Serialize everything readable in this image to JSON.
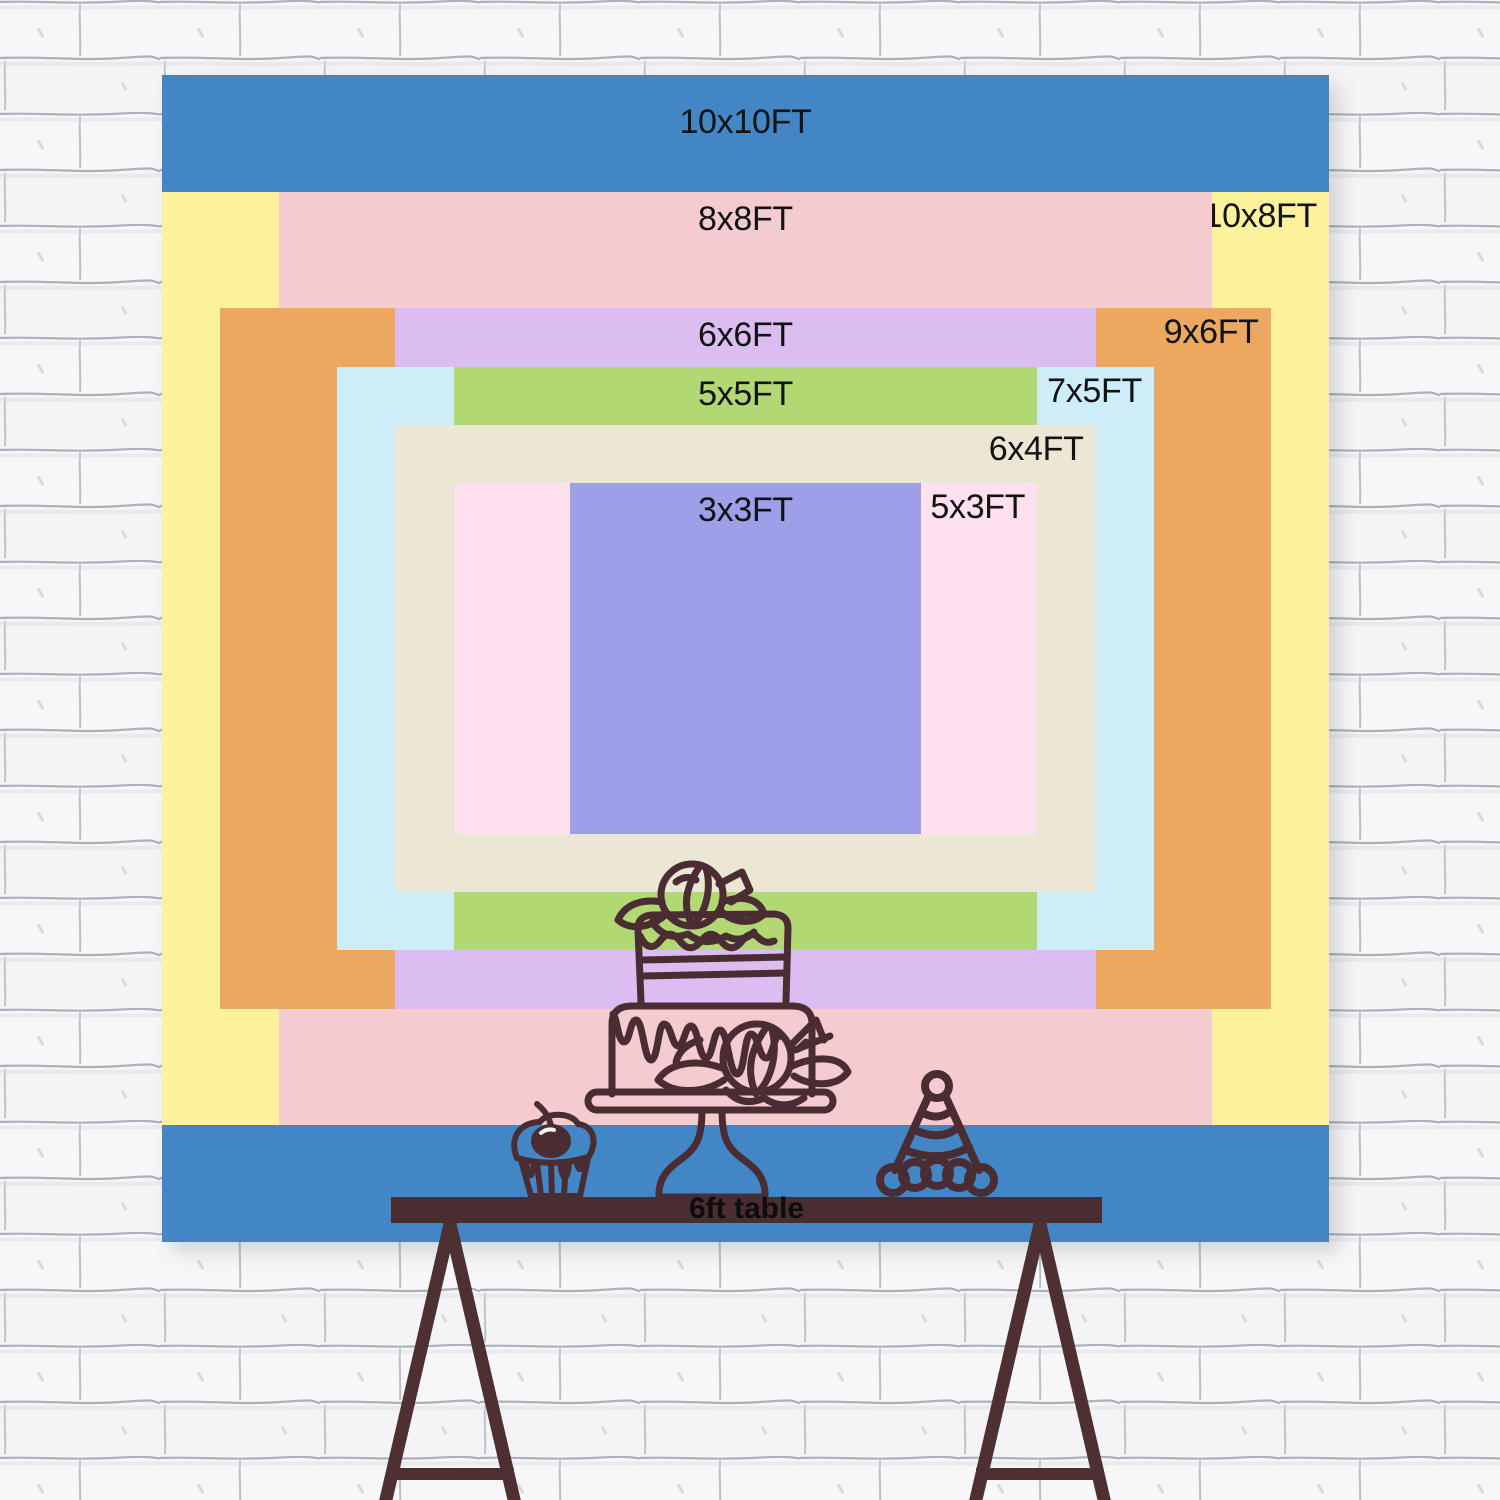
{
  "backdrop_size_chart": {
    "unit": "FT",
    "sizes": [
      {
        "label": "10x10FT",
        "w": 10,
        "h": 10,
        "color": "#4286c6",
        "label_anchor": "top-center"
      },
      {
        "label": "10x8FT",
        "w": 10,
        "h": 8,
        "color": "#fbf29b",
        "label_anchor": "top-right"
      },
      {
        "label": "8x8FT",
        "w": 8,
        "h": 8,
        "color": "#f4cbce",
        "label_anchor": "top-center"
      },
      {
        "label": "9x6FT",
        "w": 9,
        "h": 6,
        "color": "#eba85e",
        "label_anchor": "top-right"
      },
      {
        "label": "6x6FT",
        "w": 6,
        "h": 6,
        "color": "#dcbdf1",
        "label_anchor": "top-center"
      },
      {
        "label": "7x5FT",
        "w": 7,
        "h": 5,
        "color": "#cdeef8",
        "label_anchor": "top-right"
      },
      {
        "label": "5x5FT",
        "w": 5,
        "h": 5,
        "color": "#b2d873",
        "label_anchor": "top-center"
      },
      {
        "label": "6x4FT",
        "w": 6,
        "h": 4,
        "color": "#ece6d4",
        "label_anchor": "top-right"
      },
      {
        "label": "5x3FT",
        "w": 5,
        "h": 3,
        "color": "#fee0ef",
        "label_anchor": "top-right"
      },
      {
        "label": "3x3FT",
        "w": 3,
        "h": 3,
        "color": "#9d9fe8",
        "label_anchor": "top-center"
      }
    ],
    "table": {
      "label": "6ft table",
      "color": "#4a2d31"
    },
    "decoration_icons": [
      "tiered-cake-icon",
      "cupcake-with-cherry-icon",
      "party-hat-icon"
    ],
    "line_art_color": "#4a2c33",
    "text_color": "#121212",
    "wall_style": "white-brick"
  }
}
